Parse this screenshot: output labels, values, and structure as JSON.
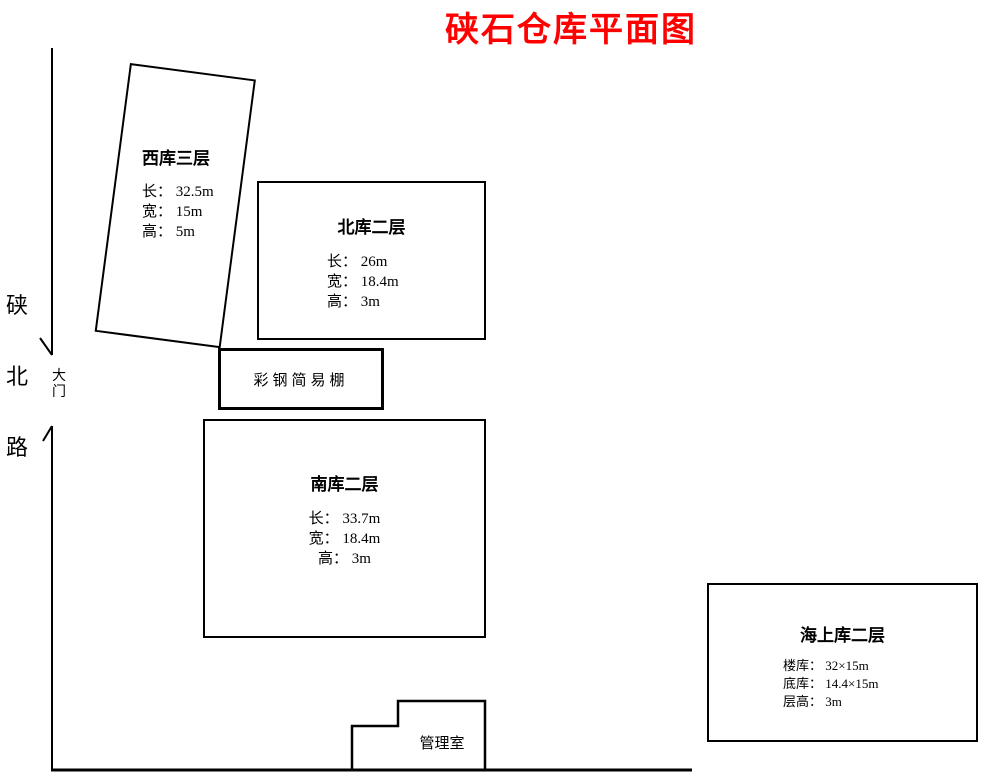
{
  "title": {
    "text": "硖石仓库平面图",
    "color": "#ff0000"
  },
  "road": {
    "name": "硖北路",
    "gate_label": "大门"
  },
  "buildings": {
    "west": {
      "name": "西库三层",
      "specs": [
        "长： 32.5m",
        "宽： 15m",
        "高： 5m"
      ]
    },
    "north": {
      "name": "北库二层",
      "specs": [
        "长： 26m",
        "宽： 18.4m",
        "高： 3m"
      ]
    },
    "shed": {
      "name": "彩钢简易棚"
    },
    "south": {
      "name": "南库二层",
      "specs": [
        "长： 33.7m",
        "宽： 18.4m",
        "高： 3m"
      ]
    },
    "sea": {
      "name": "海上库二层",
      "specs": [
        "楼库： 32×15m",
        "底库： 14.4×15m",
        "层高： 3m"
      ]
    },
    "office": {
      "name": "管理室"
    }
  },
  "colors": {
    "line": "#000000",
    "title_red": "#ff0000"
  }
}
